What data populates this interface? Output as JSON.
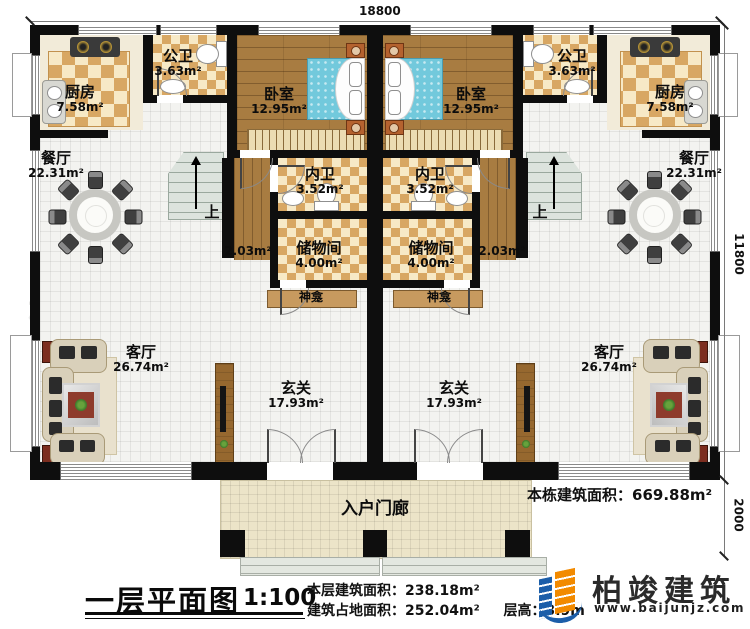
{
  "plan": {
    "dim_width": "18800",
    "dim_height_upper": "11800",
    "dim_height_lower": "2000"
  },
  "rooms": {
    "kitchen": {
      "name": "厨房",
      "area": "7.58m²"
    },
    "public_bath": {
      "name": "公卫",
      "area": "3.63m²"
    },
    "bedroom": {
      "name": "卧室",
      "area": "12.95m²"
    },
    "dining": {
      "name": "餐厅",
      "area": "22.31m²"
    },
    "inner_bath": {
      "name": "内卫",
      "area": "3.52m²"
    },
    "storage": {
      "name": "储物间",
      "area": "4.00m²"
    },
    "passage": {
      "area": "2.03m²"
    },
    "shrine": {
      "name": "神龛"
    },
    "living": {
      "name": "客厅",
      "area": "26.74m²"
    },
    "foyer": {
      "name": "玄关",
      "area": "17.93m²"
    },
    "porch": {
      "name": "入户门廊"
    },
    "stairs": {
      "up": "上"
    }
  },
  "notes": {
    "total_label": "本栋建筑面积：",
    "total_value": "669.88m²"
  },
  "footer": {
    "title": "一层平面图",
    "scale": "1:100",
    "floor_area_label": "本层建筑面积：",
    "floor_area_value": "238.18m²",
    "footprint_label": "建筑占地面积：",
    "footprint_value": "252.04m²",
    "storey_label": "层高：",
    "storey_value": "3.9m"
  },
  "logo": {
    "name": "柏竣建筑",
    "url": "www.baijunjz.com"
  },
  "watermark": {
    "text": "柏竣建筑",
    "sub": "www.baijunjz.com"
  }
}
